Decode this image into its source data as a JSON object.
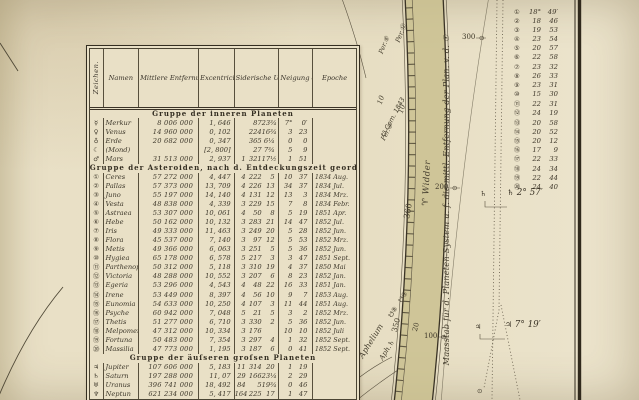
{
  "palette": {
    "paper": "#e8dfc5",
    "band_olive": "#c8be8c",
    "ink": "#3a342a",
    "line_dark": "#30291c"
  },
  "table": {
    "columns": [
      "Zeichen.",
      "Namen",
      "Mittlere Entfernung der Planeten v.d.☉ in geogr. Meilen",
      "Excentricität der Bahnen in Millionen Meilen",
      "Siderische Umlaufszeit in Jahr, Tag, Std.",
      "Neigung der Bahnen gegen die Ekliptik.",
      "Epoche"
    ],
    "groups": [
      {
        "title": "Gruppe der inneren Planeten",
        "rows": [
          {
            "sign": "☿",
            "name": "Merkur",
            "dist": "8 006 000",
            "ecc": "1, 646",
            "period": [
              "",
              "87",
              "23¾"
            ],
            "incl": [
              "7°",
              "0′"
            ],
            "epoch": ""
          },
          {
            "sign": "♀",
            "name": "Venus",
            "dist": "14 960 000",
            "ecc": "0, 102",
            "period": [
              "",
              "224",
              "16¾"
            ],
            "incl": [
              "3",
              "23"
            ],
            "epoch": ""
          },
          {
            "sign": "♁",
            "name": "Erde",
            "dist": "20 682 000",
            "ecc": "0, 347",
            "period": [
              "",
              "365",
              "6¼"
            ],
            "incl": [
              "0",
              "0"
            ],
            "epoch": ""
          },
          {
            "sign": "☾",
            "name": "(Mond)",
            "dist": "",
            "ecc": "[2, 800]",
            "period": [
              "",
              "27",
              "7¾"
            ],
            "incl": [
              "5",
              "9"
            ],
            "epoch": ""
          },
          {
            "sign": "♂",
            "name": "Mars",
            "dist": "31 513 000",
            "ecc": "2, 937",
            "period": [
              "1",
              "321",
              "17½"
            ],
            "incl": [
              "1",
              "51"
            ],
            "epoch": ""
          }
        ]
      },
      {
        "title": "Gruppe der Asteroiden, nach d. Entdeckungszeit geordnet.",
        "rows": [
          {
            "sign": "①",
            "name": "Ceres",
            "dist": "57 272 000",
            "ecc": "4, 447",
            "period": [
              "4",
              "222",
              "5"
            ],
            "incl": [
              "10",
              "37"
            ],
            "epoch": "1834 Aug."
          },
          {
            "sign": "②",
            "name": "Pallas",
            "dist": "57 373 000",
            "ecc": "13, 709",
            "period": [
              "4",
              "226",
              "13"
            ],
            "incl": [
              "34",
              "37"
            ],
            "epoch": "1834 Jul."
          },
          {
            "sign": "③",
            "name": "Juno",
            "dist": "55 197 000",
            "ecc": "14, 140",
            "period": [
              "4",
              "131",
              "12"
            ],
            "incl": [
              "13",
              "3"
            ],
            "epoch": "1834 Mrz."
          },
          {
            "sign": "④",
            "name": "Vesta",
            "dist": "48 838 000",
            "ecc": "4, 339",
            "period": [
              "3",
              "229",
              "15"
            ],
            "incl": [
              "7",
              "8"
            ],
            "epoch": "1834 Febr."
          },
          {
            "sign": "⑤",
            "name": "Astraea",
            "dist": "53 307 000",
            "ecc": "10, 061",
            "period": [
              "4",
              "50",
              "8"
            ],
            "incl": [
              "5",
              "19"
            ],
            "epoch": "1851 Apr."
          },
          {
            "sign": "⑥",
            "name": "Hebe",
            "dist": "50 162 000",
            "ecc": "10, 132",
            "period": [
              "3",
              "283",
              "21"
            ],
            "incl": [
              "14",
              "47"
            ],
            "epoch": "1852 Jul."
          },
          {
            "sign": "⑦",
            "name": "Iris",
            "dist": "49 333 000",
            "ecc": "11, 463",
            "period": [
              "3",
              "249",
              "20"
            ],
            "incl": [
              "5",
              "28"
            ],
            "epoch": "1852 Jun."
          },
          {
            "sign": "⑧",
            "name": "Flora",
            "dist": "45 537 000",
            "ecc": "7, 140",
            "period": [
              "3",
              "97",
              "12"
            ],
            "incl": [
              "5",
              "53"
            ],
            "epoch": "1852 Mrz."
          },
          {
            "sign": "⑨",
            "name": "Metis",
            "dist": "49 366 000",
            "ecc": "6, 063",
            "period": [
              "3",
              "251",
              "5"
            ],
            "incl": [
              "5",
              "36"
            ],
            "epoch": "1852 Jun."
          },
          {
            "sign": "⑩",
            "name": "Hygiea",
            "dist": "65 178 000",
            "ecc": "6, 578",
            "period": [
              "5",
              "217",
              "3"
            ],
            "incl": [
              "3",
              "47"
            ],
            "epoch": "1851 Sept."
          },
          {
            "sign": "⑪",
            "name": "Parthenope",
            "dist": "50 312 000",
            "ecc": "5, 118",
            "period": [
              "3",
              "310",
              "19"
            ],
            "incl": [
              "4",
              "37"
            ],
            "epoch": "1850 Mai"
          },
          {
            "sign": "⑫",
            "name": "Victoria",
            "dist": "48 288 000",
            "ecc": "10, 552",
            "period": [
              "3",
              "207",
              "6"
            ],
            "incl": [
              "8",
              "23"
            ],
            "epoch": "1852 Jan."
          },
          {
            "sign": "⑬",
            "name": "Egeria",
            "dist": "53 296 000",
            "ecc": "4, 543",
            "period": [
              "4",
              "48",
              "22"
            ],
            "incl": [
              "16",
              "33"
            ],
            "epoch": "1851 Jan."
          },
          {
            "sign": "⑭",
            "name": "Irene",
            "dist": "53 449 000",
            "ecc": "8, 397",
            "period": [
              "4",
              "56",
              "10"
            ],
            "incl": [
              "9",
              "7"
            ],
            "epoch": "1853 Aug."
          },
          {
            "sign": "⑮",
            "name": "Eunomia",
            "dist": "54 633 000",
            "ecc": "10, 250",
            "period": [
              "4",
              "107",
              "3"
            ],
            "incl": [
              "11",
              "44"
            ],
            "epoch": "1851 Aug."
          },
          {
            "sign": "⑯",
            "name": "Psyche",
            "dist": "60 942 000",
            "ecc": "7, 048",
            "period": [
              "5",
              "21",
              "5"
            ],
            "incl": [
              "3",
              "2"
            ],
            "epoch": "1852 Mrz."
          },
          {
            "sign": "⑰",
            "name": "Thetis",
            "dist": "51 277 000",
            "ecc": "6, 710",
            "period": [
              "3",
              "330",
              "2"
            ],
            "incl": [
              "5",
              "36"
            ],
            "epoch": "1852 Jun."
          },
          {
            "sign": "⑱",
            "name": "Melpomene",
            "dist": "47 312 000",
            "ecc": "10, 334",
            "period": [
              "3",
              "176",
              ""
            ],
            "incl": [
              "10",
              "10"
            ],
            "epoch": "1852 Juli"
          },
          {
            "sign": "⑲",
            "name": "Fortuna",
            "dist": "50 483 000",
            "ecc": "7, 354",
            "period": [
              "3",
              "297",
              "4"
            ],
            "incl": [
              "1",
              "32"
            ],
            "epoch": "1852 Sept."
          },
          {
            "sign": "⑳",
            "name": "Massilia",
            "dist": "47 773 000",
            "ecc": "1, 195",
            "period": [
              "3",
              "187",
              "6"
            ],
            "incl": [
              "0",
              "41"
            ],
            "epoch": "1852 Sept."
          }
        ]
      },
      {
        "title": "Gruppe der äuſseren groſsen Planeten",
        "rows": [
          {
            "sign": "♃",
            "name": "Jupiter",
            "dist": "107 606 000",
            "ecc": "5, 183",
            "period": [
              "11",
              "314",
              "20"
            ],
            "incl": [
              "1",
              "19"
            ],
            "epoch": ""
          },
          {
            "sign": "♄",
            "name": "Saturn",
            "dist": "197 288 000",
            "ecc": "11, 07",
            "period": [
              "29",
              "166",
              "23¼"
            ],
            "incl": [
              "2",
              "29"
            ],
            "epoch": ""
          },
          {
            "sign": "♅",
            "name": "Uranus",
            "dist": "396 741 000",
            "ecc": "18, 492",
            "period": [
              "84",
              "5",
              "19¾"
            ],
            "incl": [
              "0",
              "46"
            ],
            "epoch": ""
          },
          {
            "sign": "♆",
            "name": "Neptun",
            "dist": "621 234 000",
            "ecc": "5, 417",
            "period": [
              "164",
              "225",
              "17"
            ],
            "incl": [
              "1",
              "47"
            ],
            "epoch": ""
          }
        ]
      }
    ]
  },
  "band": {
    "widder_sym": "♈",
    "widder": "Widder",
    "deg360": "360",
    "deg350": "350",
    "deg20": "20",
    "deg10a": "10",
    "deg10b": "10",
    "per6": "Per.⑥",
    "per12": "Per.⑫",
    "per9": "Per.⑨",
    "com1843": "☋ Com. 1843",
    "aphelium": "Aphelium",
    "aph_sat": "Aph.♄",
    "node_a": "☋⑨",
    "node_b": "☋⑧"
  },
  "ruler": {
    "label": "Maasstab für d. Planeten-System u. f. die mittl. Entfernung der Plan. v. d. ☉",
    "ticks": [
      "300",
      "200",
      "100"
    ],
    "marker": "⊙"
  },
  "annotations": {
    "list": [
      {
        "n": "①",
        "d": "18°",
        "m": "49′"
      },
      {
        "n": "②",
        "d": "18",
        "m": "46"
      },
      {
        "n": "③",
        "d": "19",
        "m": "53"
      },
      {
        "n": "④",
        "d": "23",
        "m": "54"
      },
      {
        "n": "⑤",
        "d": "20",
        "m": "57"
      },
      {
        "n": "⑥",
        "d": "22",
        "m": "58"
      },
      {
        "n": "⑦",
        "d": "23",
        "m": "32"
      },
      {
        "n": "⑧",
        "d": "26",
        "m": "33"
      },
      {
        "n": "⑨",
        "d": "23",
        "m": "31"
      },
      {
        "n": "⑩",
        "d": "15",
        "m": "30"
      },
      {
        "n": "⑪",
        "d": "22",
        "m": "31"
      },
      {
        "n": "⑫",
        "d": "24",
        "m": "19"
      },
      {
        "n": "⑬",
        "d": "20",
        "m": "58"
      },
      {
        "n": "⑭",
        "d": "20",
        "m": "52"
      },
      {
        "n": "⑮",
        "d": "20",
        "m": "12"
      },
      {
        "n": "⑯",
        "d": "17",
        "m": "9"
      },
      {
        "n": "⑰",
        "d": "22",
        "m": "33"
      },
      {
        "n": "⑱",
        "d": "24",
        "m": "34"
      },
      {
        "n": "⑲",
        "d": "22",
        "m": "44"
      },
      {
        "n": "⑳",
        "d": "24",
        "m": "40"
      }
    ],
    "saturn_marker": "♄",
    "saturn_note_sym": "♄",
    "saturn_note_val": "2° 57′",
    "jupiter_marker": "♃",
    "jupiter_note_sym": "♃",
    "jupiter_note_val": "7° 19′",
    "end_marker": "⊙"
  }
}
